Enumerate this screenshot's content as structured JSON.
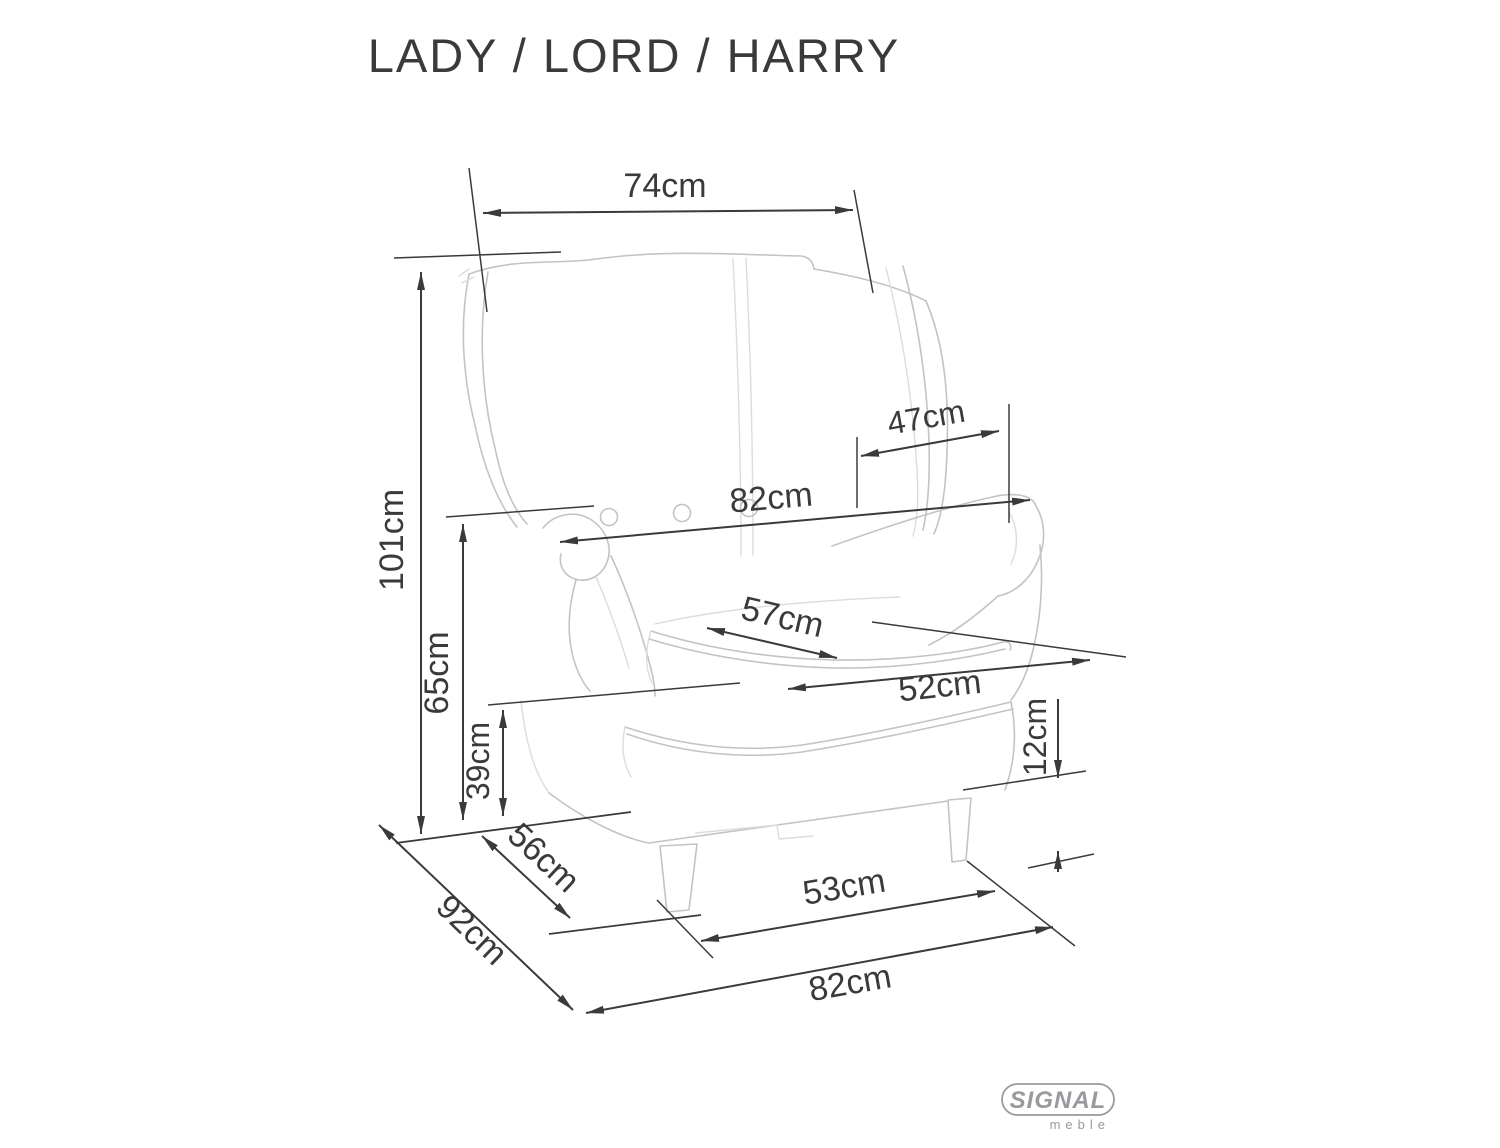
{
  "title": "LADY / LORD / HARRY",
  "brand": {
    "name": "SIGNAL",
    "sub": "meble"
  },
  "colors": {
    "dimension": "#3a3a3c",
    "sketch": "#c3c3c7",
    "logo": "#9a9a9e",
    "background": "#ffffff"
  },
  "dimensions": {
    "overall_width_top": "74cm",
    "overall_height": "101cm",
    "backrest_height": "65cm",
    "seat_height": "39cm",
    "armrest_depth": "47cm",
    "width_between_armrests": "82cm",
    "seat_depth": "57cm",
    "seat_width": "52cm",
    "leg_height": "12cm",
    "base_depth": "56cm",
    "overall_depth": "92cm",
    "front_feet_span": "53cm",
    "overall_width_bottom": "82cm"
  }
}
